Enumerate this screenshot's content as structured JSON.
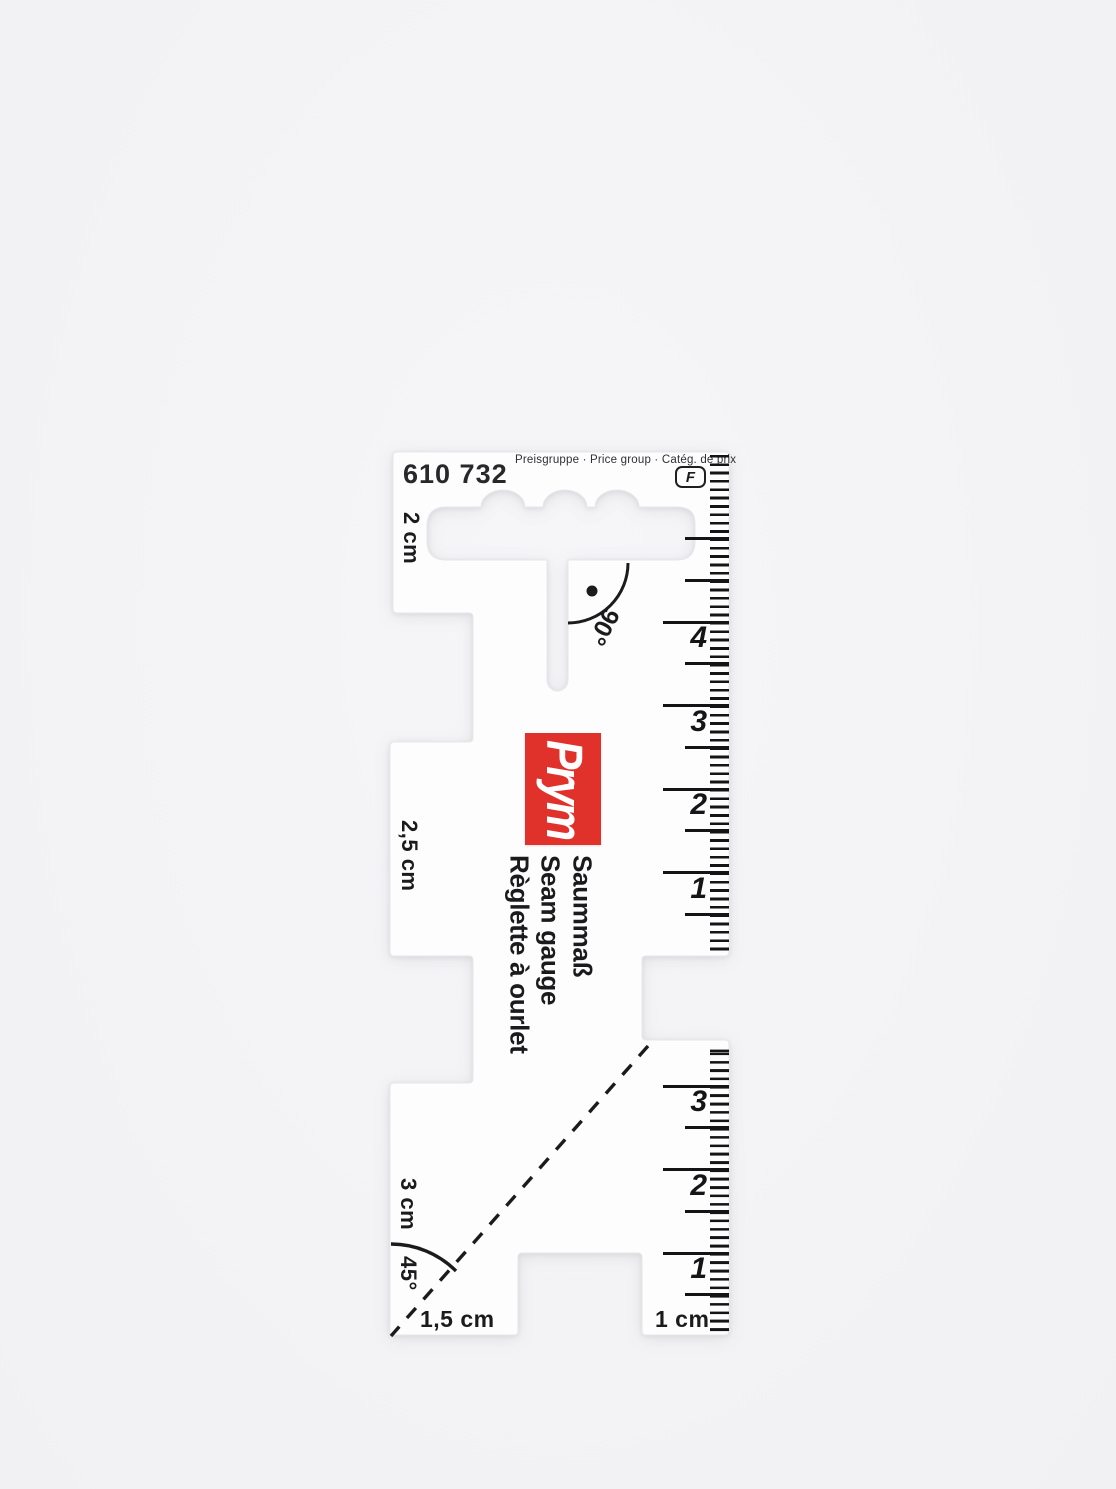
{
  "header": {
    "part_number": "610 732",
    "price_group_label": "Preisgruppe · Price group · Catég. de prix",
    "price_group_value": "F"
  },
  "brand": {
    "logo_text": "Prym"
  },
  "names": [
    "Saummaß",
    "Seam gauge",
    "Règlette à ourlet"
  ],
  "labels": {
    "tab_top": "2 cm",
    "tab_middle": "2,5 cm",
    "tab_bottom": "3 cm",
    "angle_right": "90°",
    "angle_bottom": "45°",
    "notch_width": "1,5 cm",
    "edge_width": "1 cm"
  },
  "rulers": {
    "top": [
      "4",
      "3",
      "2",
      "1"
    ],
    "bottom": [
      "3",
      "2",
      "1"
    ]
  },
  "colors": {
    "background": "#f3f3f5",
    "plastic": "#fdfdfe",
    "print_black": "#1b1b1d",
    "brand_red": "#e0312a"
  }
}
